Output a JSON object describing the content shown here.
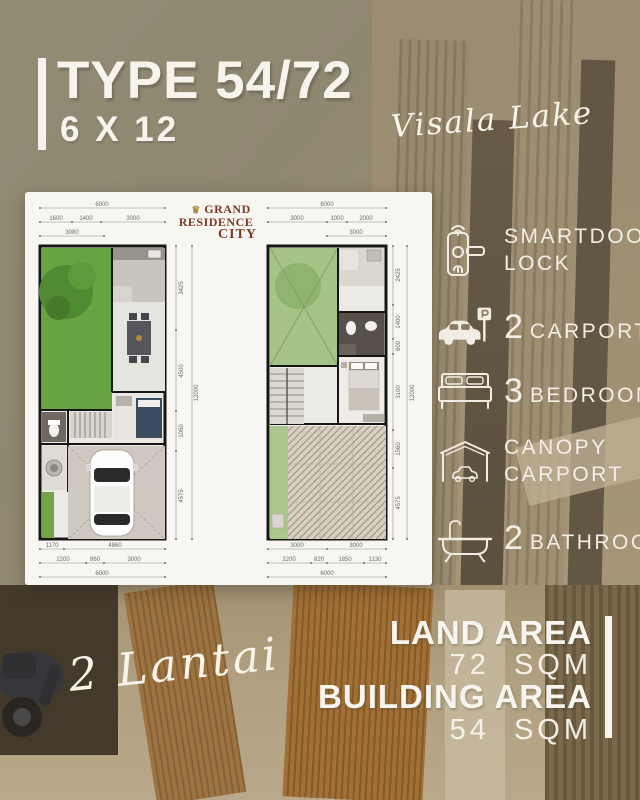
{
  "header": {
    "title": "TYPE 54/72",
    "subtitle": "6 X 12",
    "location": "Visala Lake"
  },
  "branding": {
    "crown": "♛",
    "line1": "GRAND",
    "line2": "RESIDENCE",
    "line3": "CITY"
  },
  "features": [
    {
      "name": "smartdoor-lock",
      "line1": "SMARTDOOR",
      "line2": "LOCK"
    },
    {
      "name": "carport",
      "number": "2",
      "label": "CARPORT"
    },
    {
      "name": "bedrooms",
      "number": "3",
      "label": "BEDROOMS"
    },
    {
      "name": "canopy-carport",
      "line1": "CANOPY",
      "line2": "CARPORT"
    },
    {
      "name": "bathroom",
      "number": "2",
      "label": "BATHROOM"
    }
  ],
  "floors_label": "2 Lantai",
  "area_info": {
    "land_label": "LAND AREA",
    "land_value": "72 SQM",
    "building_label": "BUILDING AREA",
    "building_value": "54 SQM"
  },
  "plans": {
    "floor1": {
      "dims_top": [
        "6000",
        "1600",
        "1400",
        "3000",
        "3080"
      ],
      "dims_bottom": [
        "1170",
        "4860",
        "2200",
        "860",
        "3000",
        "6000"
      ],
      "dims_right": [
        "3425",
        "4500",
        "1060",
        "4575",
        "12000"
      ]
    },
    "floor2": {
      "dims_top": [
        "6000",
        "3000",
        "1000",
        "2000",
        "3000"
      ],
      "dims_bottom": [
        "3000",
        "3000",
        "2200",
        "820",
        "1850",
        "1130",
        "6000"
      ],
      "dims_right": [
        "2425",
        "1400",
        "600",
        "3100",
        "1560",
        "4575",
        "12000"
      ]
    }
  },
  "colors": {
    "accent_white": "#f6f3ec",
    "logo_maroon": "#7c3b28",
    "logo_gold": "#b08d3e",
    "garden_green": "#68a342",
    "roof_garden_green": "#a6c488",
    "wood_brown": "#a46c2f",
    "background_olive": "#8d8a77"
  }
}
